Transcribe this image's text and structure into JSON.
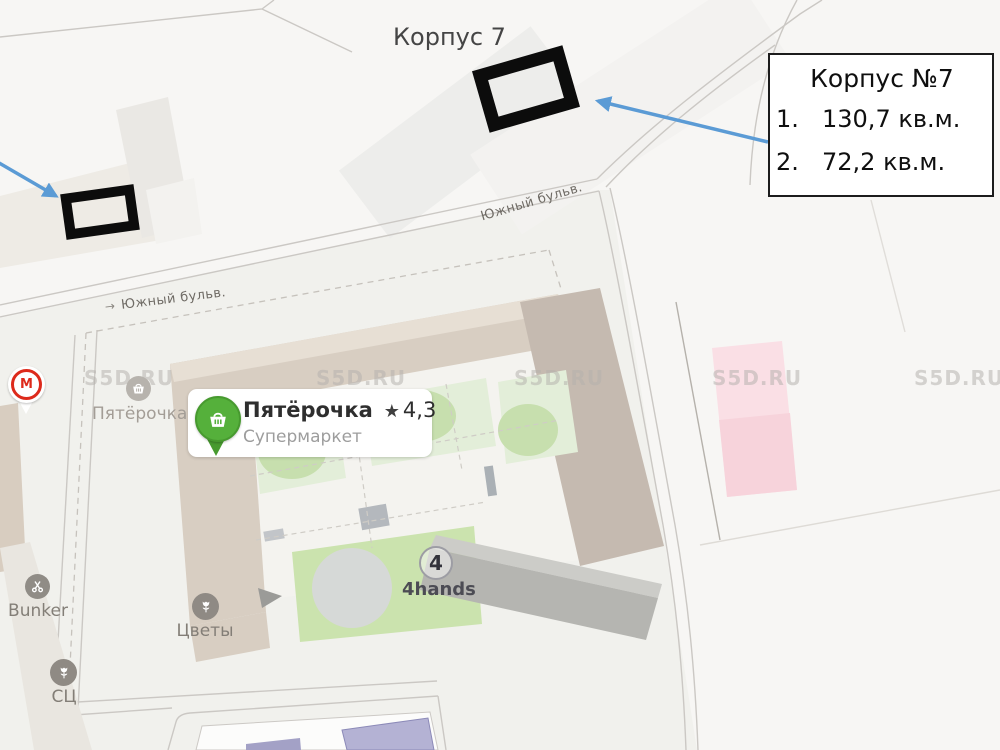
{
  "overlay": {
    "corpus_label": "Корпус 7",
    "info_box": {
      "title": "Корпус №7",
      "items": [
        {
          "num": "1.",
          "area": "130,7 кв.м."
        },
        {
          "num": "2.",
          "area": "72,2 кв.м."
        }
      ]
    }
  },
  "map": {
    "watermark": "S5D.RU",
    "streets": {
      "south_blvd_top": "Южный бульв.",
      "south_blvd_left": "Южный бульв.",
      "direction_arrow": "→"
    },
    "pois": {
      "pyaterochka_card": {
        "title": "Пятёрочка",
        "star": "★",
        "rating": "4,3",
        "subtitle": "Супермаркет"
      },
      "pyaterochka_map_label": "Пятёрочка",
      "magnit_letter": "М",
      "bunker": "Bunker",
      "flowers": "Цветы",
      "service_center": "СЦ",
      "fourhands": {
        "badge": "4",
        "label": "4hands"
      }
    },
    "colors": {
      "annotation_blue": "#5b9bd5",
      "pyaterochka_green": "#55b03b",
      "magnit_red": "#dd2a1b",
      "pink_building": "#f9d9e0",
      "building_tan": "#d8cec2"
    }
  }
}
